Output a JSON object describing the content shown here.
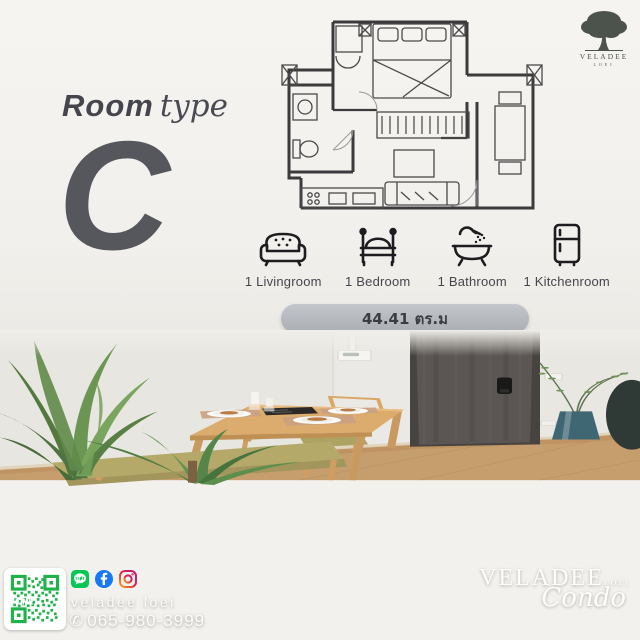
{
  "header": {
    "room_word": "Room",
    "type_word": "type",
    "letter": "C"
  },
  "top_logo": {
    "brand": "VELADEE",
    "subtitle": "LOEI"
  },
  "features": [
    {
      "icon": "sofa-icon",
      "label": "1 Livingroom"
    },
    {
      "icon": "bed-icon",
      "label": "1 Bedroom"
    },
    {
      "icon": "bathtub-icon",
      "label": "1 Bathroom"
    },
    {
      "icon": "fridge-icon",
      "label": "1 Kitchenroom"
    }
  ],
  "area_badge": {
    "label": "44.41 ตร.ม"
  },
  "contact": {
    "qr_label": "LINE",
    "social": [
      {
        "icon": "line-icon"
      },
      {
        "icon": "facebook-icon"
      },
      {
        "icon": "instagram-icon"
      }
    ],
    "username": "veladee loei",
    "phone_icon": "✆",
    "phone": "065-980-3999"
  },
  "watermark": {
    "brand": "VELADEE",
    "sub": "LOEI",
    "script": "Condo"
  },
  "colors": {
    "line_green": "#06C755",
    "facebook_blue": "#1877F2",
    "qr_green": "#21B24B",
    "pill_gray": "#b5b8bd",
    "letter_gray": "#56575c",
    "door_brown": "#5b5653",
    "wood_floor": "#c69d6d"
  }
}
